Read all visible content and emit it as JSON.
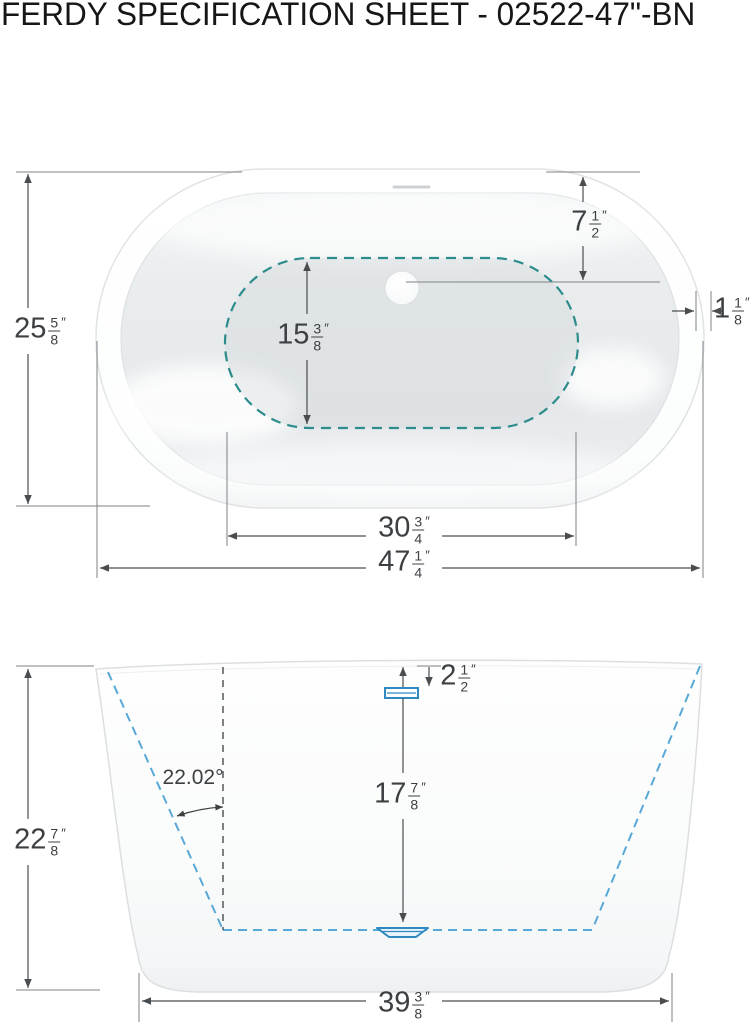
{
  "title": "FERDY SPECIFICATION SHEET - 02522-47\"-BN",
  "top_view": {
    "dims": {
      "tub_width": {
        "whole": "25",
        "num": "5",
        "den": "8",
        "unit": "″"
      },
      "drain_offset": {
        "whole": "7",
        "num": "1",
        "den": "2",
        "unit": "″"
      },
      "rim_width": {
        "whole": "1",
        "num": "1",
        "den": "8",
        "unit": "″"
      },
      "basin_width": {
        "whole": "15",
        "num": "3",
        "den": "8",
        "unit": "″"
      },
      "basin_length": {
        "whole": "30",
        "num": "3",
        "den": "4",
        "unit": "″"
      },
      "overall_length": {
        "whole": "47",
        "num": "1",
        "den": "4",
        "unit": "″"
      }
    }
  },
  "side_view": {
    "wall_angle": "22.02°",
    "dims": {
      "overall_height": {
        "whole": "22",
        "num": "7",
        "den": "8",
        "unit": "″"
      },
      "overflow_drop": {
        "whole": "2",
        "num": "1",
        "den": "2",
        "unit": "″"
      },
      "water_depth": {
        "whole": "17",
        "num": "7",
        "den": "8",
        "unit": "″"
      },
      "base_length": {
        "whole": "39",
        "num": "3",
        "den": "8",
        "unit": "″"
      }
    }
  },
  "colors": {
    "basin_dash_teal": "#2d8c8c",
    "profile_dash_blue": "#58a8d8",
    "fixture_blue": "#2f8ac2",
    "dimension_line": "#4a4d4f",
    "dimension_text": "#3d4043",
    "ext_line": "#7d8286"
  }
}
